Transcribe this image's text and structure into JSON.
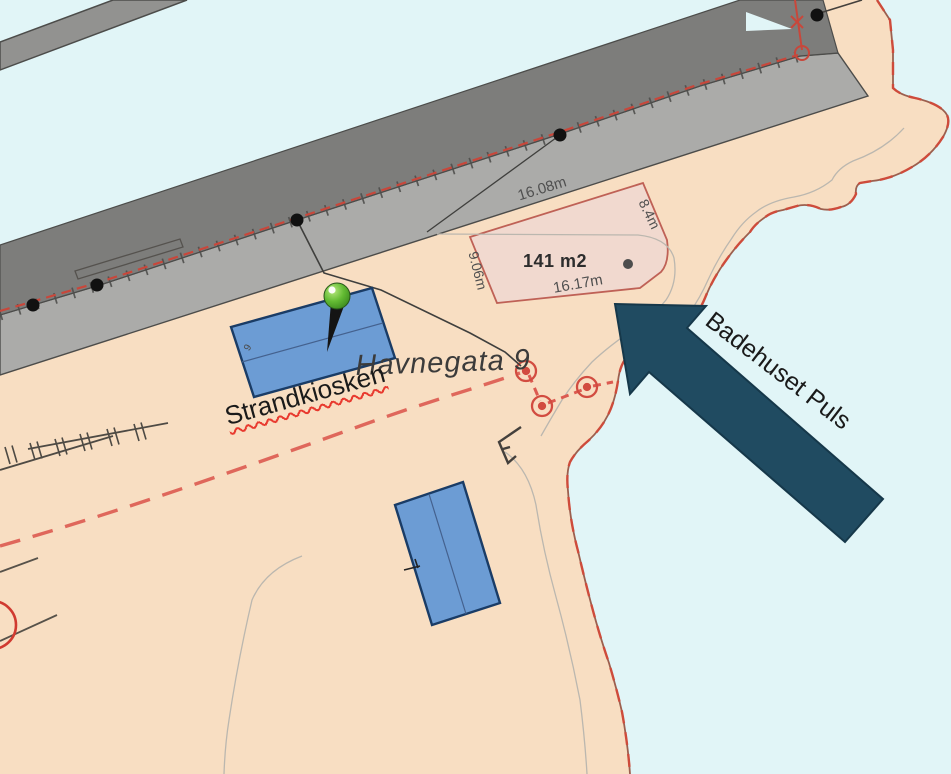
{
  "map": {
    "street_label": "Havnegata 9",
    "kiosk_label": "Strandkiosken",
    "arrow_label": "Badehuset Puls",
    "building_number": "9",
    "parcel": {
      "area_label": "141 m2",
      "dim_top": "16.08m",
      "dim_right": "8.4m",
      "dim_left": "9.06m",
      "dim_bottom": "16.17m"
    },
    "colors": {
      "water": "#E1F5F7",
      "land": "#F8DEC2",
      "pier_deck": "#ABABA9",
      "pier_edge": "#7D7D7B",
      "pier_strip": "#929290",
      "parcel_fill": "rgba(238,215,210,0.78)",
      "parcel_border": "#BF6156",
      "building_fill": "#6C9CD4",
      "building_outline": "#1A3C66",
      "boundary_red": "#DC5A50",
      "coast_red": "#CE4B3B",
      "arrow_fill": "#204B61",
      "pin_green": "#5FB732"
    }
  }
}
